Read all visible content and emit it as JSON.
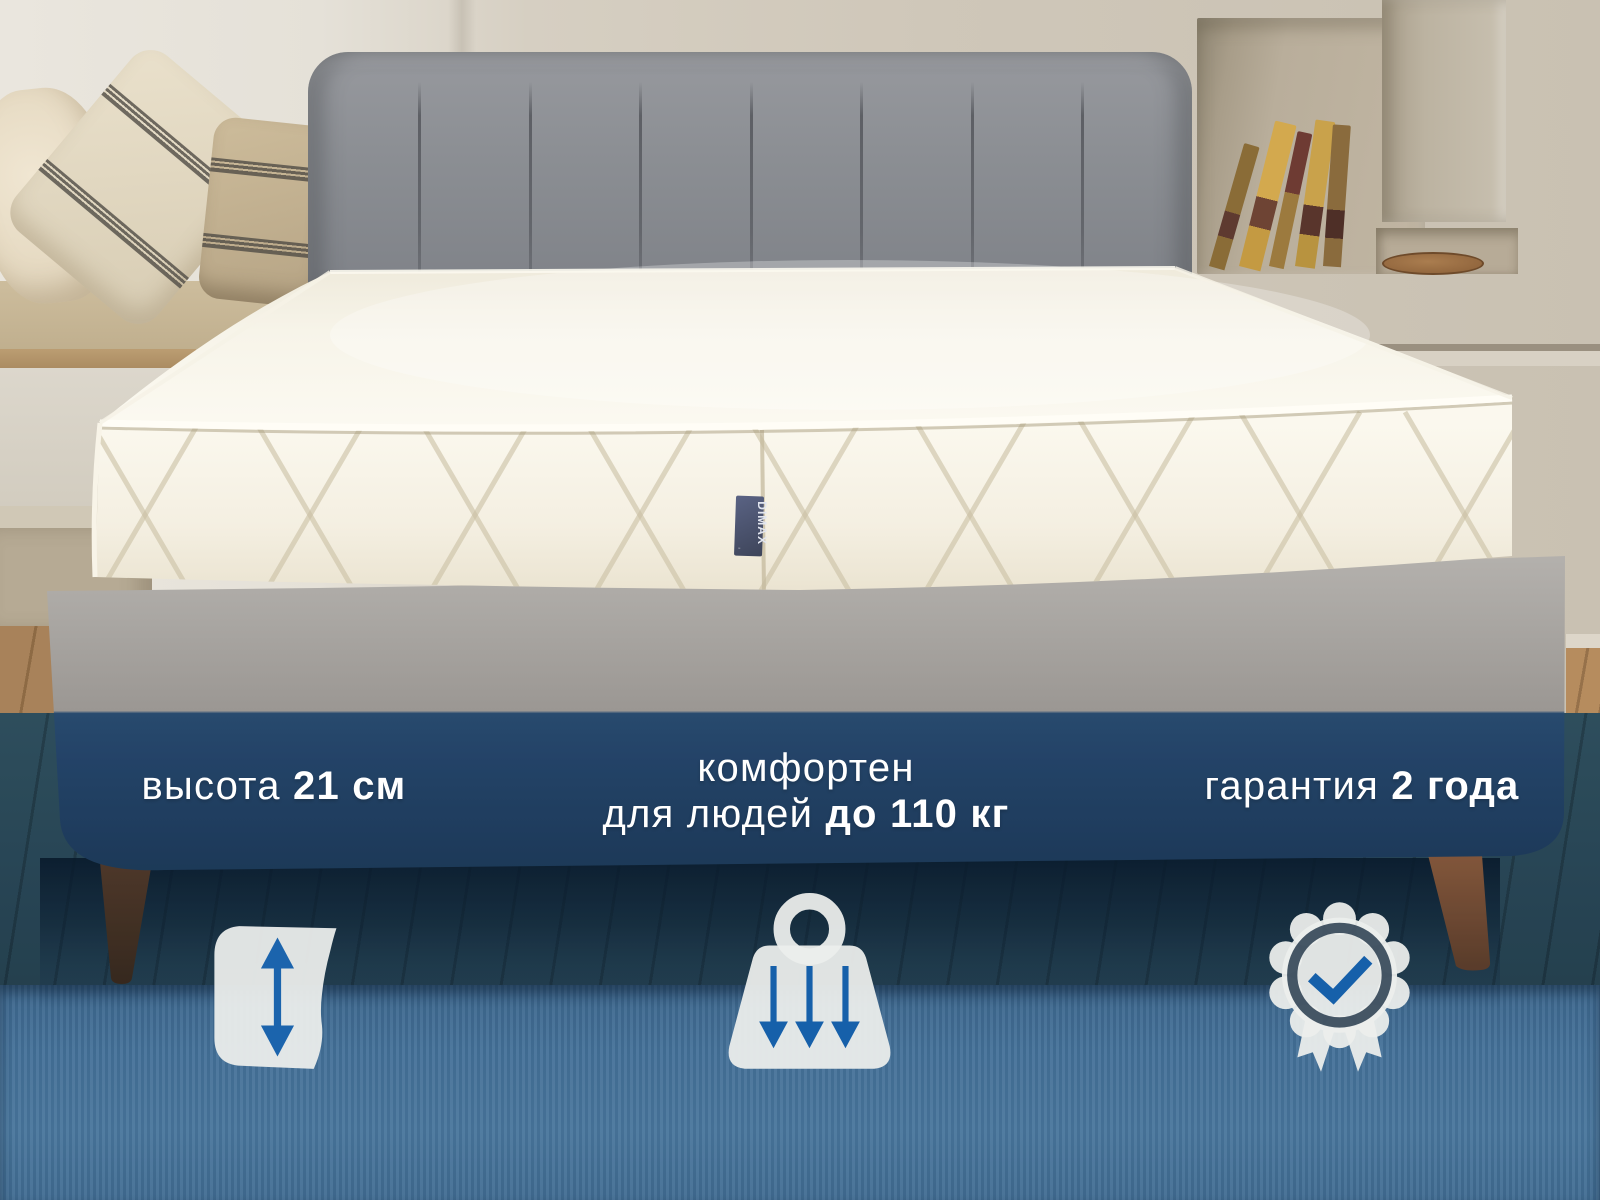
{
  "brand": {
    "tag_text": "DIMAX"
  },
  "overlay": {
    "features": [
      {
        "name": "height",
        "label": "высота ",
        "value": "21 см",
        "icon": "mattress-height-icon"
      },
      {
        "name": "comfort",
        "line1": "комфортен",
        "line2_label": "для людей ",
        "line2_value": "до 110 кг",
        "icon": "weight-load-icon"
      },
      {
        "name": "warranty",
        "label": "гарантия ",
        "value": "2 года",
        "icon": "award-badge-icon"
      }
    ],
    "text_color": "#ffffff",
    "accent_blue": "#1b64ad",
    "icon_white": "#eceeec",
    "overlay_navy": "#24466a"
  },
  "palette": {
    "wall_beige": "#cdc5b7",
    "headboard_gray": "#8b8e93",
    "mattress_white": "#f7f4e9",
    "bed_base_gray": "#a3a09c",
    "bed_base_tinted": "#25456a",
    "carpet_blue": "#4a78a1",
    "wood_floor": "#a8825a",
    "tag_navy": "#474f6b"
  }
}
